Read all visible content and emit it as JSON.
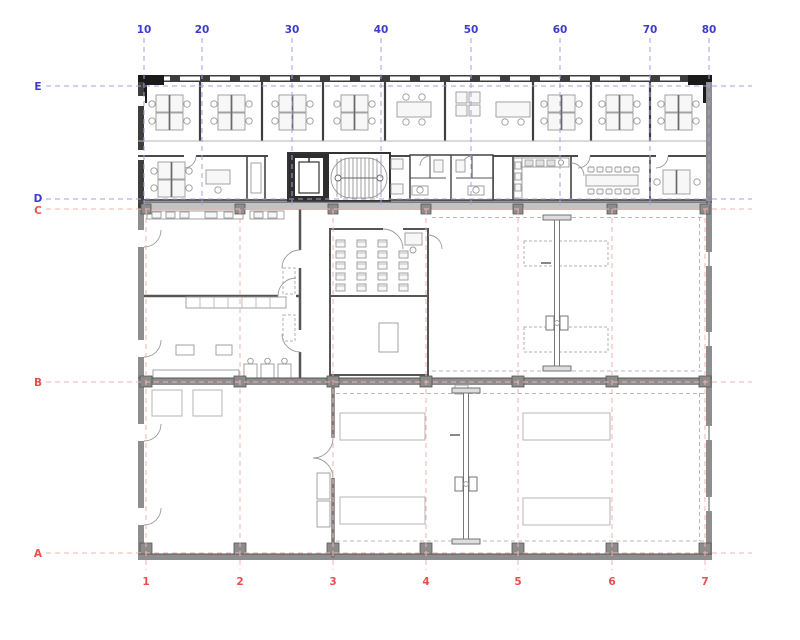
{
  "drawing": {
    "type": "architectural-floor-plan",
    "axes": {
      "top": [
        "10",
        "20",
        "30",
        "40",
        "50",
        "60",
        "70",
        "80"
      ],
      "left": [
        "E",
        "D",
        "C",
        "B",
        "A"
      ],
      "bottom": [
        "1",
        "2",
        "3",
        "4",
        "5",
        "6",
        "7"
      ]
    },
    "colors": {
      "axis_blue": "#3c3ccc",
      "axis_blue_line": "#a3a3dd",
      "axis_red": "#ee4d4d",
      "axis_red_line": "#f3b3af",
      "wall_dark": "#3d3d3d",
      "wall_medium": "#8e8e8e",
      "wall_light": "#c2c2c2",
      "furniture_stroke": "#999999"
    }
  }
}
